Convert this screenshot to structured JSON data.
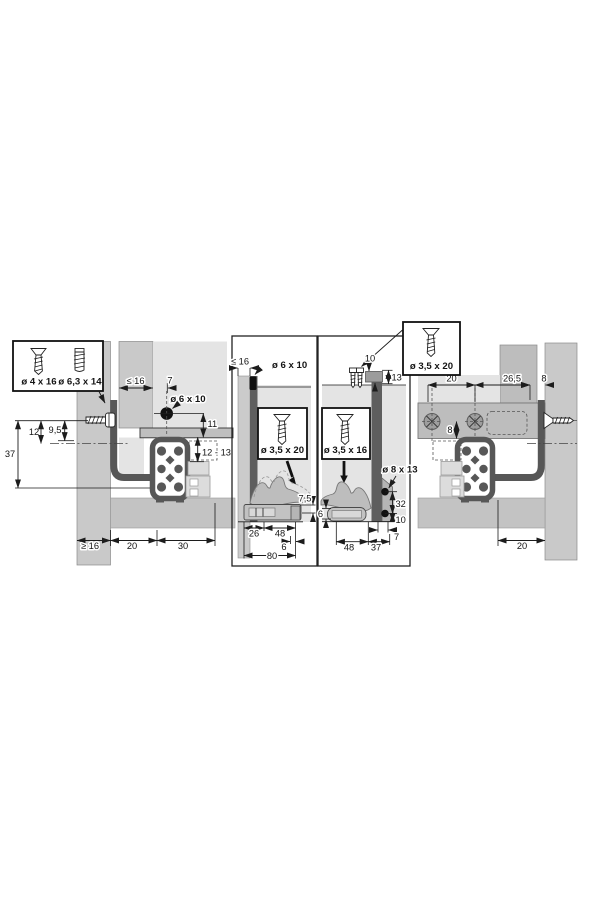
{
  "left": {
    "box": {
      "s1": "ø 4 x 16",
      "s2": "ø 6,3 x 14"
    },
    "d37": "37",
    "d12": "12",
    "d9_5": "9,5",
    "dle16": "≤ 16",
    "d7": "7",
    "hole": "ø 6 x 10",
    "d11": "11",
    "d12_13": "12 - 13",
    "dge16": "≥ 16",
    "d20": "20",
    "d30": "30"
  },
  "panel_a": {
    "dle16": "≤ 16",
    "hole": "ø 6 x 10",
    "screw": "ø 3,5 x 20",
    "d7_5": "7,5",
    "d26": "26",
    "d48": "48",
    "d6": "6",
    "d80": "80"
  },
  "panel_b": {
    "d10_top": "10",
    "d13": "13",
    "screw": "ø 3,5 x 16",
    "hole": "ø 8 x 13",
    "d32": "32",
    "d10": "10",
    "d7": "7",
    "d6": "6",
    "d48": "48",
    "d37": "37"
  },
  "right": {
    "box": "ø 3,5 x 20",
    "d20_top": "20",
    "d26_5": "26,5",
    "d8_top": "8",
    "d8": "8",
    "d20": "20"
  }
}
